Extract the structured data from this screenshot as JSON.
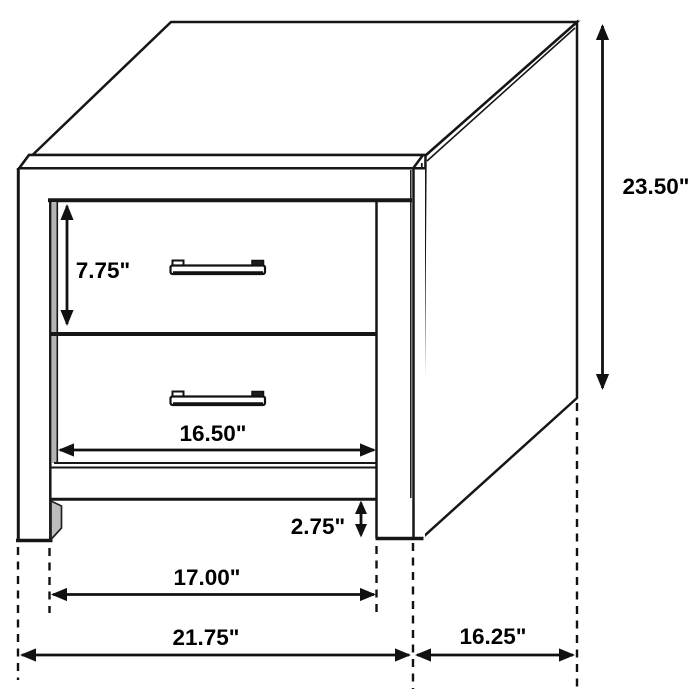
{
  "subject": "2-drawer nightstand dimension line drawing",
  "dimensions": {
    "drawer_opening_height": {
      "label": "7.75\"",
      "inches": 7.75
    },
    "overall_height": {
      "label": "23.50\"",
      "inches": 23.5
    },
    "drawer_width": {
      "label": "16.50\"",
      "inches": 16.5
    },
    "leg_height": {
      "label": "2.75\"",
      "inches": 2.75
    },
    "between_legs_width": {
      "label": "17.00\"",
      "inches": 17.0
    },
    "overall_width": {
      "label": "21.75\"",
      "inches": 21.75
    },
    "overall_depth": {
      "label": "16.25\"",
      "inches": 16.25
    }
  },
  "colors": {
    "line": "#161616",
    "background": "#ffffff",
    "shading": "#b5b5b5"
  }
}
